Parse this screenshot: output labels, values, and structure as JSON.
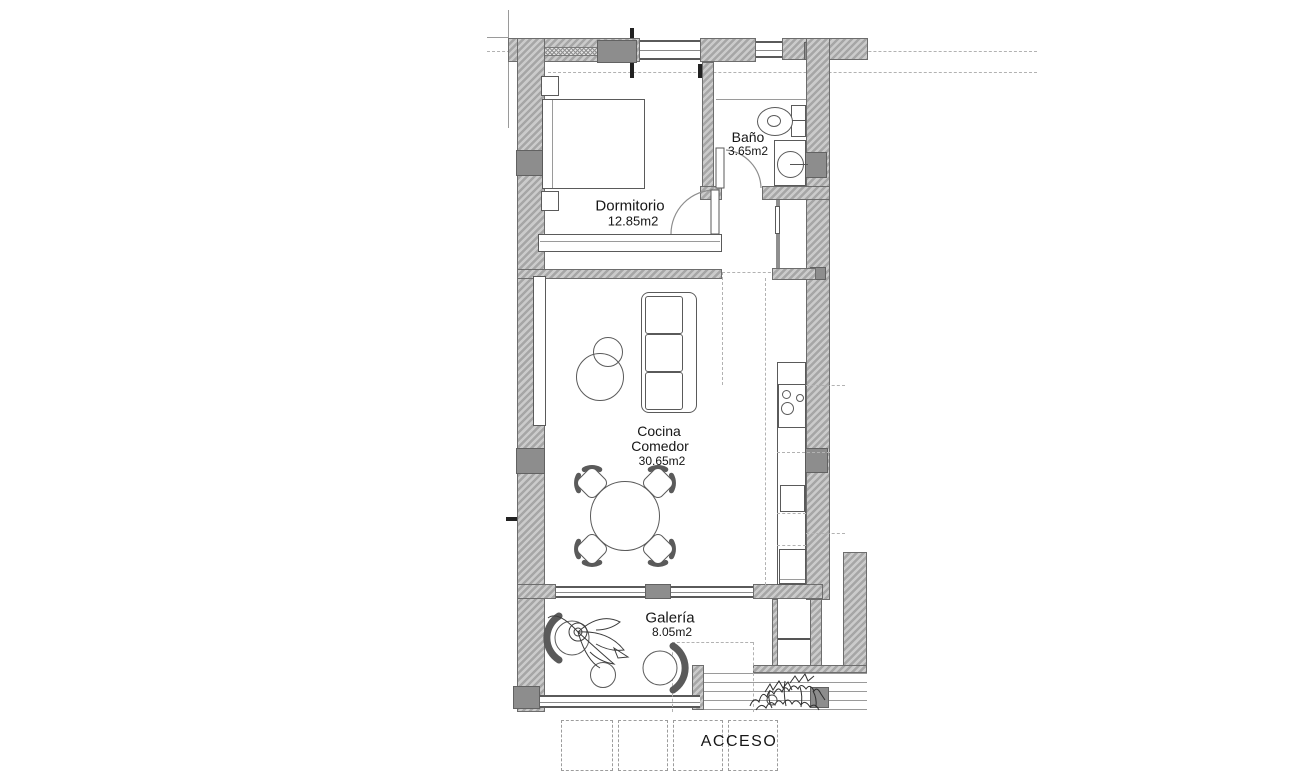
{
  "plan_title": "floor-plan",
  "rooms": {
    "dormitorio": {
      "name": "Dormitorio",
      "area": "12.85m2"
    },
    "bano": {
      "name": "Baño",
      "area": "3.65m2"
    },
    "cocina_comedor": {
      "name_line1": "Cocina",
      "name_line2": "Comedor",
      "area": "30.65m2"
    },
    "galeria": {
      "name": "Galería",
      "area": "8.05m2"
    }
  },
  "entrance": {
    "label": "ACCESO"
  },
  "colors": {
    "background": "#ffffff",
    "wall_fill": "#c7c7c7",
    "wall_hatch": "#a6a6a6",
    "column": "#8d8d8d",
    "outline": "#5a5a5a",
    "dashed_line": "#b2b2b2"
  }
}
